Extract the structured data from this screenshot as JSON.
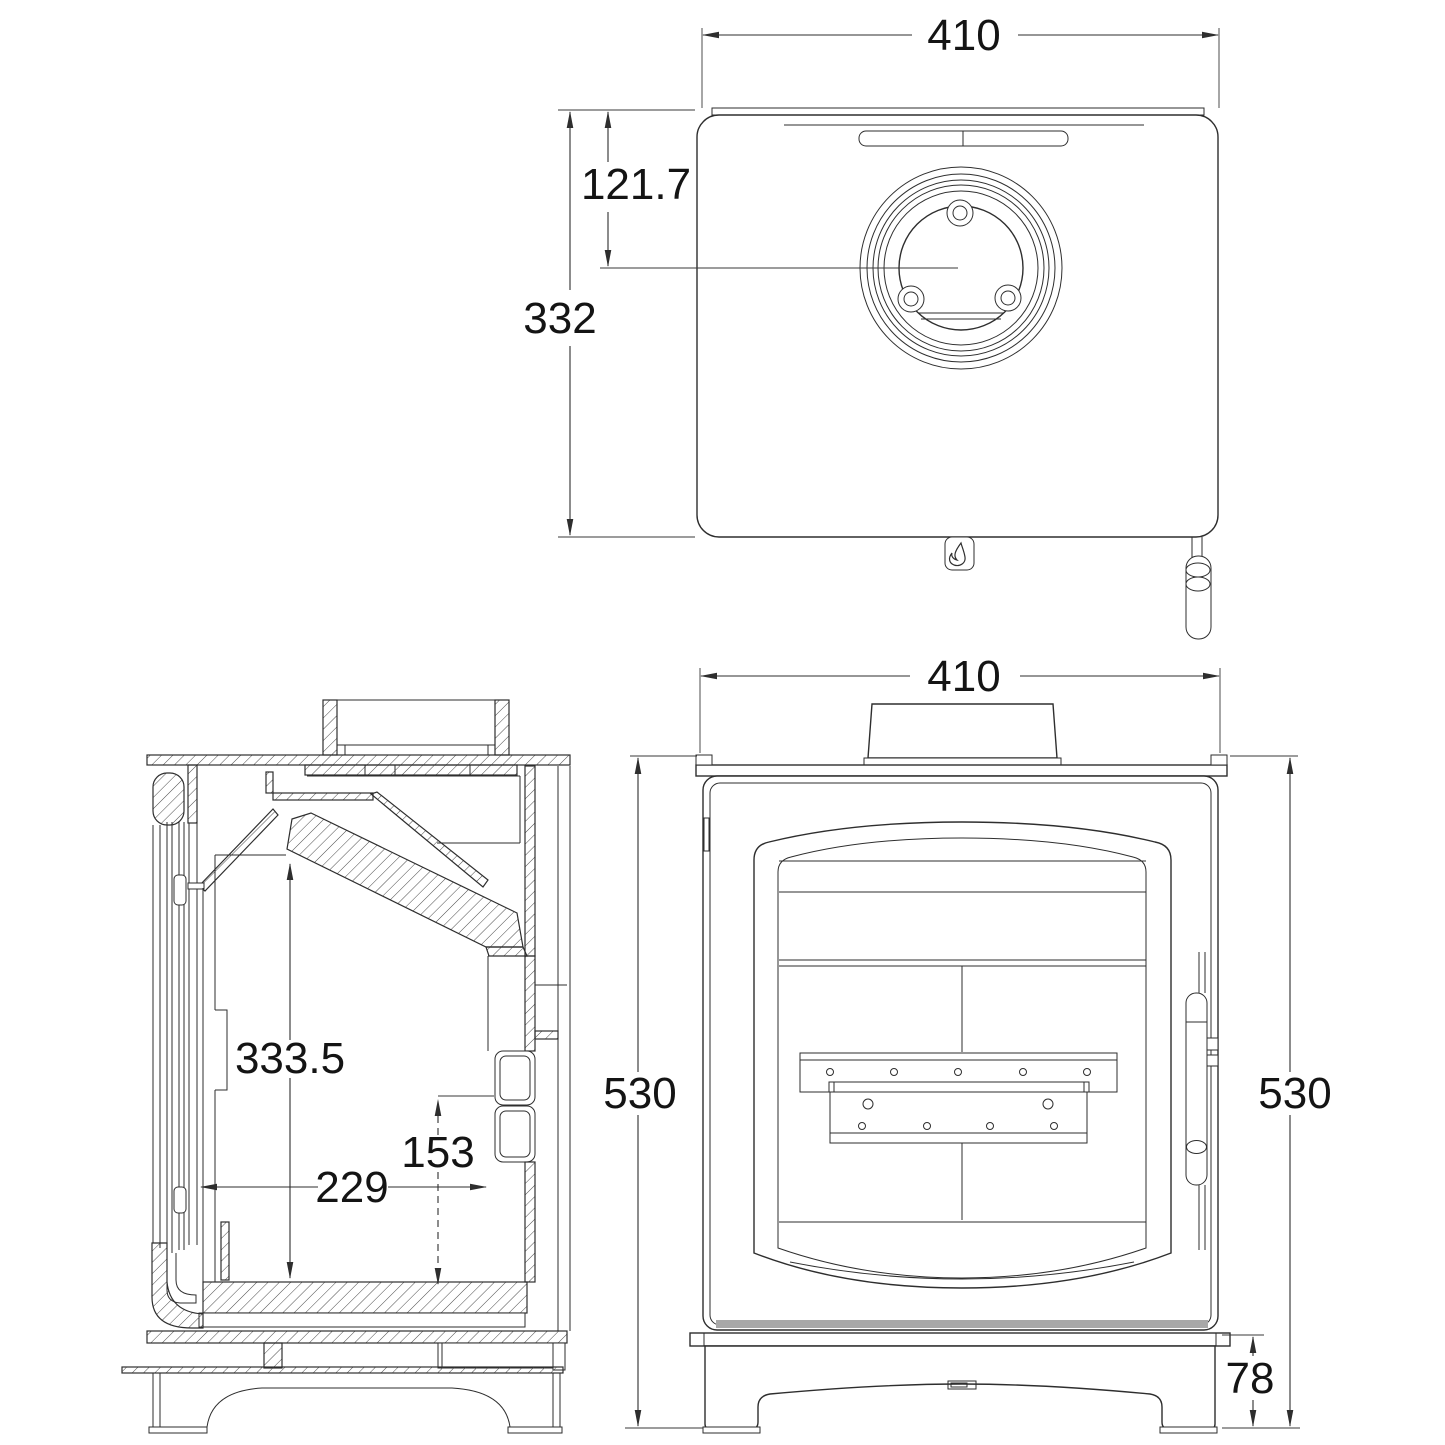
{
  "drawing": {
    "type": "technical-dimension-drawing",
    "subject": "wood-burning stove, three orthographic views",
    "colors": {
      "line": "#2e2e2e",
      "text": "#141414",
      "background": "#ffffff",
      "shadow_strip": "#a8a8a8"
    },
    "views": {
      "top": {
        "label": "top-plan-view",
        "width_mm": "410",
        "flue_centre_offset_mm": "121.7",
        "depth_mm": "332"
      },
      "side": {
        "label": "side-section-view",
        "firebox_height_mm": "333.5",
        "rear_outlet_height_mm": "153",
        "firebox_depth_mm": "229"
      },
      "front": {
        "label": "front-view",
        "width_mm": "410",
        "height_left_mm": "530",
        "height_right_mm": "530",
        "plinth_height_mm": "78"
      }
    },
    "icons": {
      "flame_badge": "flame-icon",
      "door_handle": "handle-icon",
      "flue_collar": "flue-collar-icon"
    }
  }
}
